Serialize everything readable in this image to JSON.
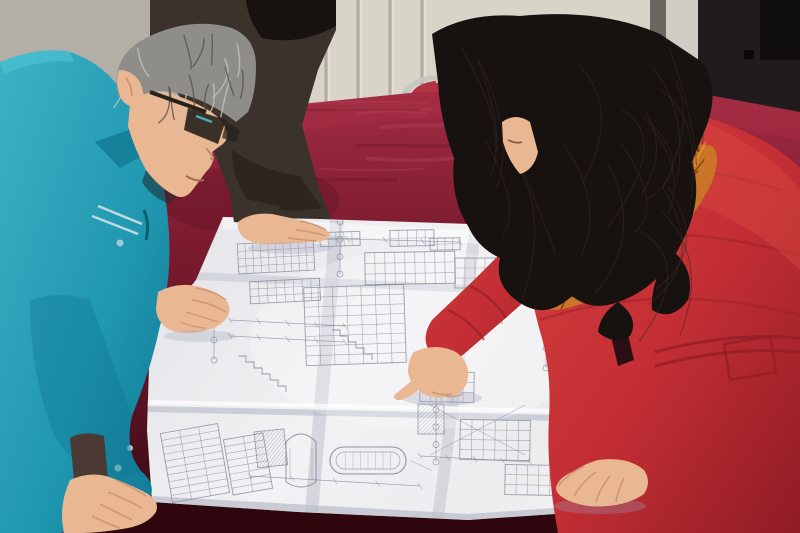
{
  "scene": {
    "kind": "photograph",
    "setting": "office/workshop room with paneled wall, dark door and a table covered in red velvet",
    "action": "three people lean over a large unfolded engineering blueprint; woman in red coat points at the drawing",
    "people": [
      {
        "id": "worker-teal",
        "position": "left",
        "features": "middle-aged man, gray hair, dark-rimmed glasses, teal work jacket, both hands on blueprint"
      },
      {
        "id": "person-dark-jacket",
        "position": "back-left",
        "features": "partially visible person in dark jacket, black hair, one hand resting on blueprint"
      },
      {
        "id": "woman-red-coat",
        "position": "right",
        "features": "woman with long dark hair, red puffer coat with orange fur collar, pointing with right index finger, left hand on blueprint"
      }
    ],
    "objects": [
      {
        "id": "blueprint",
        "desc": "large folded white engineering drawing sheet with illegible sections, elevation views, dimension tables, grid bubbles and a horizontal vessel detail"
      },
      {
        "id": "table",
        "desc": "table draped in crimson velvet cloth"
      },
      {
        "id": "chair",
        "desc": "metal-frame chair with red cushion behind the table"
      },
      {
        "id": "wall",
        "desc": "cream paneled wall with vertical grooves and a brown stain"
      },
      {
        "id": "door",
        "desc": "dark door on the right with light jamb strip"
      }
    ]
  },
  "palette": {
    "wall_left": "#b3afa6",
    "wall_panel": "#d8d4c8",
    "wall_groove": "#a6a298",
    "stain": "#7b4423",
    "door_dark": "#201c1d",
    "door_jamb": "#d0cdc4",
    "door_shadow": "#6b665f",
    "chair_cushion": "#b23440",
    "chair_metal": "#c7c7c2",
    "velvet_bright": "#9c2840",
    "velvet_mid": "#6e1627",
    "velvet_dark": "#460c18",
    "velvet_deep": "#2f060e",
    "paper": "#ececef",
    "paper_shadow": "#cdced6",
    "crease": "#bfc0cc",
    "ink": "#7c8294",
    "teal": "#1f97b0",
    "teal_dark": "#0e7490",
    "teal_light": "#3db2c6",
    "skin": "#e9b893",
    "skin_shadow": "#c98f6b",
    "gray_hair": "#8e8d89",
    "gray_hair_dark": "#55554f",
    "dark_jacket": "#3a322b",
    "black_hair": "#171110",
    "coat_red": "#c53137",
    "coat_red_dark": "#9c1f26",
    "coat_red_light": "#e05045",
    "fur_orange": "#c97427",
    "fur_dark": "#6e3a10",
    "glasses": "#26211d"
  },
  "decor": {
    "wall_grooves": {
      "x0": 262,
      "x1": 452,
      "step": 32,
      "y0": 0,
      "y1": 252
    },
    "velvet_streaks": {
      "count": 30,
      "x0": 160,
      "x1": 760,
      "y0": 98,
      "y1": 300
    },
    "fur_spikes": {
      "count": 110
    },
    "hair_strands": {
      "count": 22
    },
    "gray_strands": {
      "count": 16
    }
  },
  "blueprint": {
    "content_note": "illegible technical line work (no readable text in photo)",
    "marks": [
      {
        "t": "grid",
        "x": 238,
        "y": 242,
        "w": 76,
        "h": 30,
        "r": 4,
        "c": 10,
        "rot": -3
      },
      {
        "t": "grid",
        "x": 250,
        "y": 280,
        "w": 70,
        "h": 22,
        "r": 3,
        "c": 8,
        "rot": -3
      },
      {
        "t": "grid",
        "x": 166,
        "y": 428,
        "w": 58,
        "h": 70,
        "r": 10,
        "c": 3,
        "rot": -10
      },
      {
        "t": "grid",
        "x": 228,
        "y": 436,
        "w": 40,
        "h": 56,
        "r": 8,
        "c": 2,
        "rot": -10
      },
      {
        "t": "grid",
        "x": 305,
        "y": 286,
        "w": 100,
        "h": 78,
        "r": 8,
        "c": 7,
        "rot": -2
      },
      {
        "t": "grid",
        "x": 365,
        "y": 252,
        "w": 90,
        "h": 32,
        "r": 3,
        "c": 9,
        "rot": -1
      },
      {
        "t": "grid",
        "x": 320,
        "y": 232,
        "w": 40,
        "h": 14,
        "r": 2,
        "c": 5,
        "rot": -2
      },
      {
        "t": "grid",
        "x": 390,
        "y": 230,
        "w": 44,
        "h": 16,
        "r": 2,
        "c": 5,
        "rot": -1
      },
      {
        "t": "grid",
        "x": 430,
        "y": 238,
        "w": 30,
        "h": 12,
        "r": 2,
        "c": 4,
        "rot": -1
      },
      {
        "t": "grid",
        "x": 455,
        "y": 258,
        "w": 60,
        "h": 30,
        "r": 3,
        "c": 6,
        "rot": 0
      },
      {
        "t": "grid",
        "x": 560,
        "y": 382,
        "w": 66,
        "h": 52,
        "r": 7,
        "c": 5,
        "rot": 2
      },
      {
        "t": "grid",
        "x": 460,
        "y": 420,
        "w": 70,
        "h": 40,
        "r": 4,
        "c": 6,
        "rot": 1
      },
      {
        "t": "grid",
        "x": 420,
        "y": 372,
        "w": 54,
        "h": 30,
        "r": 3,
        "c": 5,
        "rot": 1
      },
      {
        "t": "grid",
        "x": 505,
        "y": 465,
        "w": 56,
        "h": 30,
        "r": 3,
        "c": 5,
        "rot": 1
      },
      {
        "t": "grid",
        "x": 584,
        "y": 440,
        "w": 40,
        "h": 24,
        "r": 3,
        "c": 3,
        "rot": 2
      },
      {
        "t": "hatch",
        "x": 254,
        "y": 432,
        "w": 30,
        "h": 36,
        "rot": -6
      },
      {
        "t": "hatch",
        "x": 418,
        "y": 404,
        "w": 26,
        "h": 30,
        "rot": 0
      },
      {
        "t": "vessel",
        "x": 286,
        "y": 432,
        "w": 30,
        "h": 56
      },
      {
        "t": "tank",
        "x": 330,
        "y": 447,
        "w": 76,
        "h": 27
      },
      {
        "t": "bubbles",
        "x": 340,
        "y": 222,
        "len": 52,
        "n": 4
      },
      {
        "t": "bubbles",
        "x": 436,
        "y": 392,
        "len": 70,
        "n": 5
      },
      {
        "t": "bubbles",
        "x": 546,
        "y": 328,
        "len": 40,
        "n": 3
      },
      {
        "t": "bubbles",
        "x": 214,
        "y": 300,
        "len": 60,
        "n": 4
      },
      {
        "t": "dim",
        "x1": 230,
        "y1": 320,
        "x2": 345,
        "y2": 326
      },
      {
        "t": "dim",
        "x1": 230,
        "y1": 336,
        "x2": 345,
        "y2": 342
      },
      {
        "t": "dim",
        "x1": 420,
        "y1": 456,
        "x2": 530,
        "y2": 462
      },
      {
        "t": "dim",
        "x1": 250,
        "y1": 476,
        "x2": 420,
        "y2": 486
      },
      {
        "t": "dim",
        "x1": 310,
        "y1": 238,
        "x2": 460,
        "y2": 242
      },
      {
        "t": "cross",
        "x1": 430,
        "y1": 405,
        "x2": 525,
        "y2": 455
      },
      {
        "t": "steps",
        "x": 238,
        "y": 356,
        "n": 6
      },
      {
        "t": "steps",
        "x": 332,
        "y": 330,
        "n": 5
      },
      {
        "t": "steps",
        "x": 470,
        "y": 300,
        "n": 4
      }
    ]
  }
}
